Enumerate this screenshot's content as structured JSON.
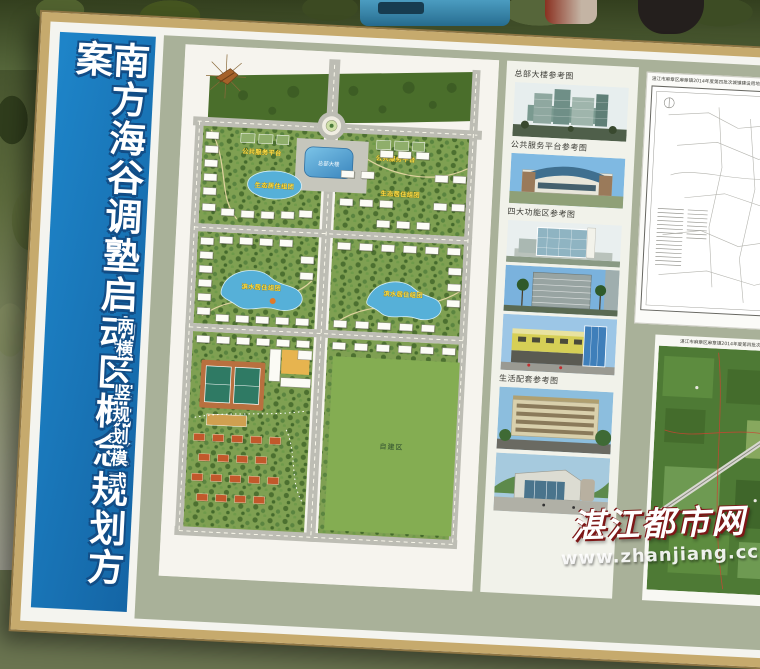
{
  "banner": {
    "title": "南方海谷调塾启动区概念规划方案",
    "subtitle": "两横一竖规划模式"
  },
  "map": {
    "labels": {
      "headquarters_building": "总部大楼",
      "public_platform_left": "公共服务平台",
      "public_platform_right": "公共服务平台",
      "residential_block_nw": "生态居住组团",
      "residential_block_ne": "生态居住组团",
      "residential_block_sw": "滨水居住组团",
      "residential_block_se": "滨水居住组团",
      "self_build_zone": "自建区"
    }
  },
  "reference_column": {
    "captions": {
      "headquarters": "总部大楼参考图",
      "public_platform": "公共服务平台参考图",
      "function_zones": "四大功能区参考图",
      "living_support": "生活配套参考图"
    }
  },
  "side_panels": {
    "survey_map_title": "湛江市麻章区麻章镇2014年度第四批次城镇建设用地(占补平衡)勘测定界图",
    "aerial_photo_caption": "湛江市麻章区麻章镇2014年度第四批次城镇建设用地"
  },
  "watermark": {
    "site_name": "湛江都市网",
    "site_url": "www.zhanjiang.cc"
  },
  "colors": {
    "banner_blue": "#1878bf",
    "board_frame_gold": "#c6aa6d",
    "mat_sage": "#a9b199",
    "map_green": "#7fa052",
    "forest_green": "#4a6e2b",
    "water_blue": "#56b0d8",
    "label_yellow": "#ffe24a"
  }
}
